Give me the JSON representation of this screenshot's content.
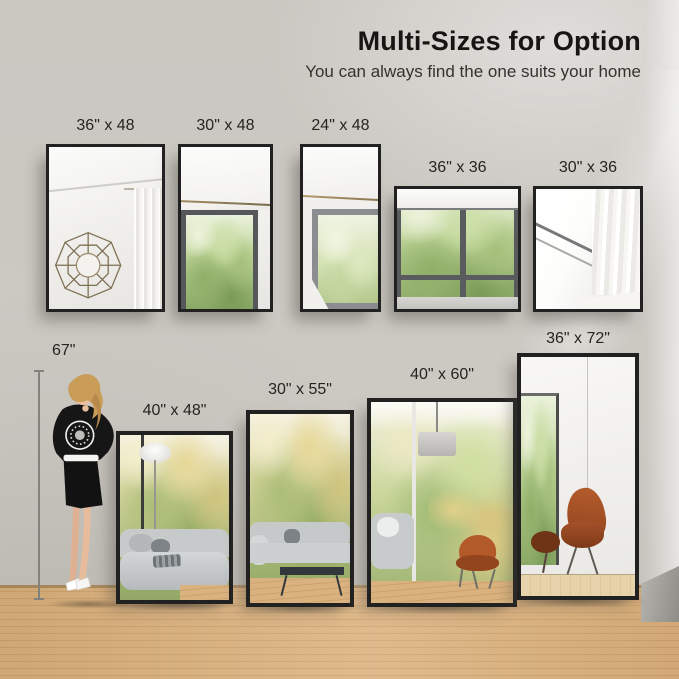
{
  "header": {
    "title": "Multi-Sizes for Option",
    "subtitle": "You can always find the one suits your home"
  },
  "height_marker": {
    "label": "67\""
  },
  "wall_mirrors": [
    {
      "size": "36x48",
      "label": "36\" x 48"
    },
    {
      "size": "30x48",
      "label": "30\" x 48"
    },
    {
      "size": "24x48",
      "label": "24\" x 48"
    },
    {
      "size": "36x36",
      "label": "36\" x 36"
    },
    {
      "size": "30x36",
      "label": "30\" x 36"
    }
  ],
  "floor_mirrors": [
    {
      "size": "40x48",
      "label": "40\" x 48\""
    },
    {
      "size": "30x55",
      "label": "30\" x 55\""
    },
    {
      "size": "40x60",
      "label": "40\" x 60\""
    },
    {
      "size": "36x72",
      "label": "36\" x 72\""
    }
  ],
  "colors": {
    "wall": "#cbc8c2",
    "floor_wood": "#d9ad77",
    "mirror_frame": "#212121",
    "title_text": "#171513"
  }
}
